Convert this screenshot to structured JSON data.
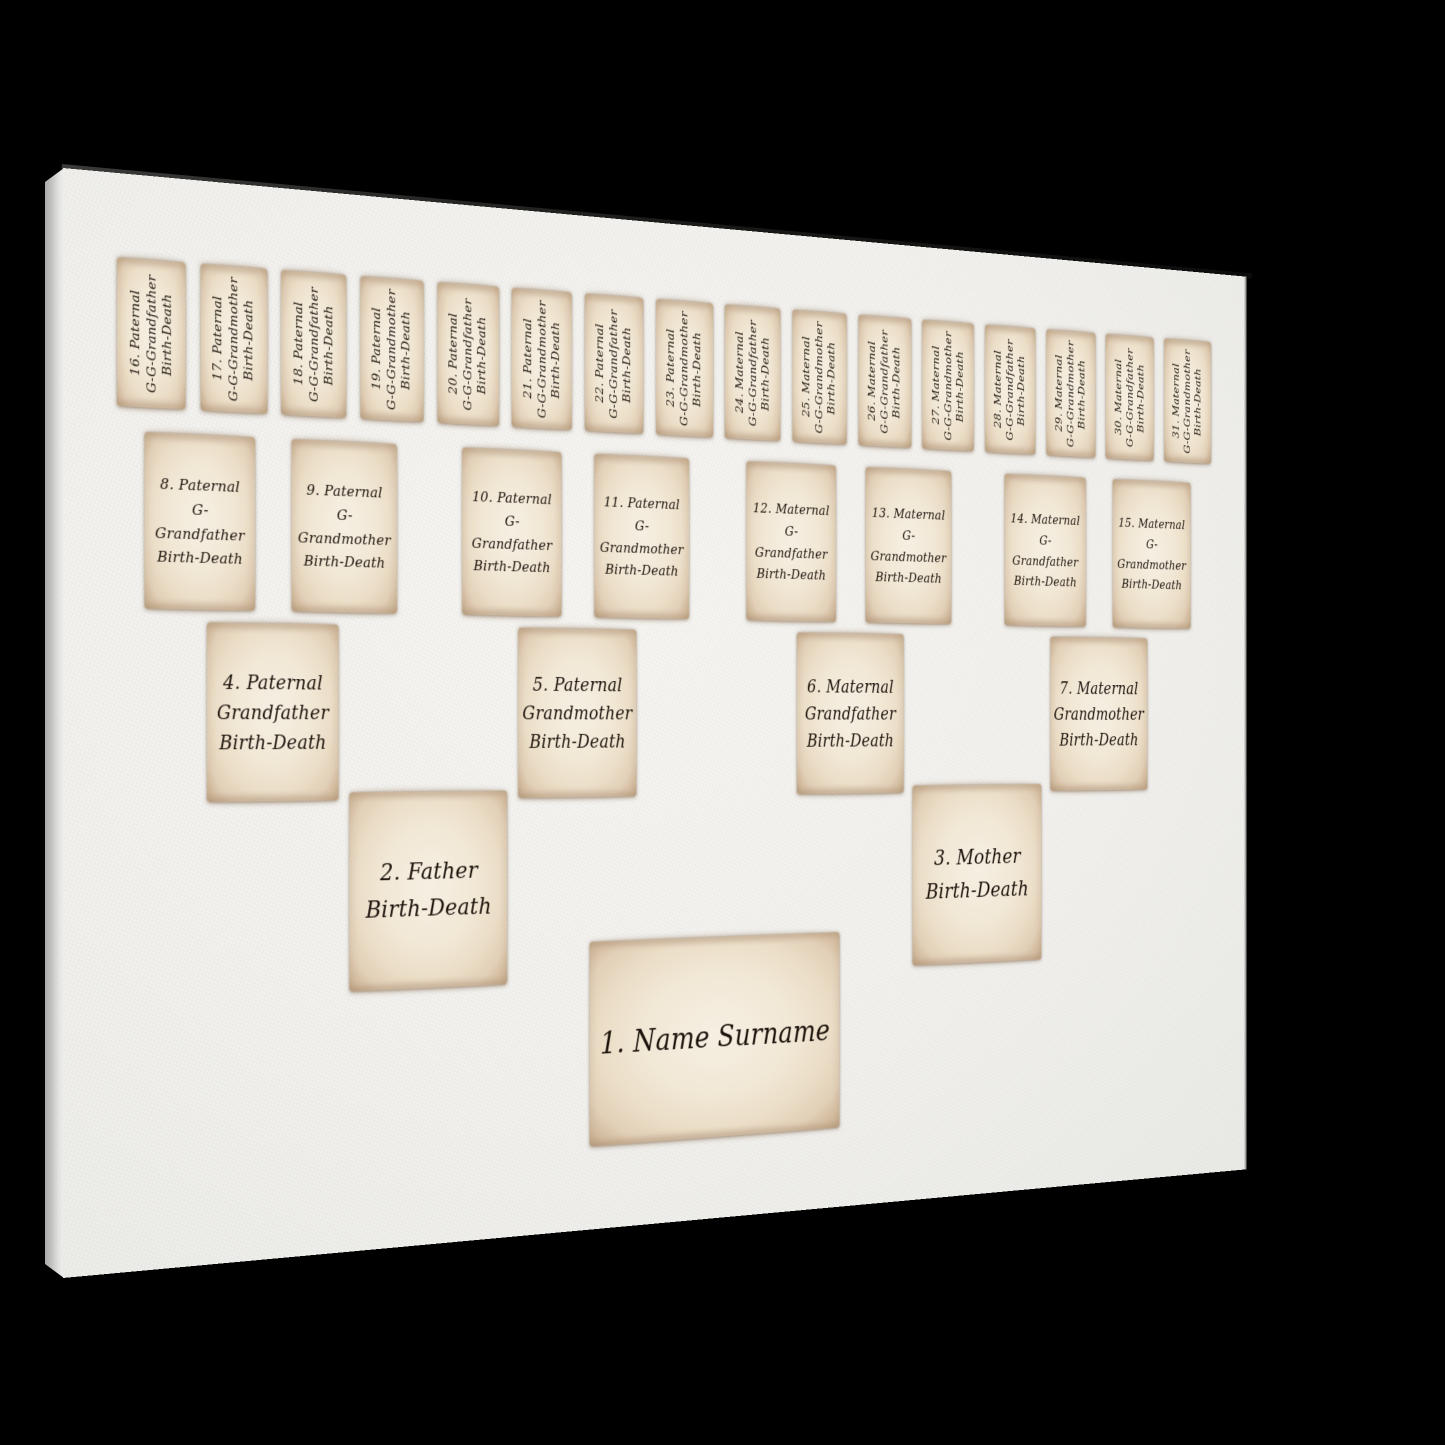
{
  "colors": {
    "background": "#000000",
    "canvas_face": "#f2f1ee",
    "canvas_edge": "#c3c3c1",
    "paper": "#f1e8d6",
    "paper_edge": "#bfa486",
    "ink": "#1c130c"
  },
  "tree": {
    "rows": [
      {
        "generation": "great-great-grandparents",
        "cards": [
          {
            "lines": [
              "16. Paternal",
              "G-G-Grandfather",
              "Birth-Death"
            ]
          },
          {
            "lines": [
              "17. Paternal",
              "G-G-Grandmother",
              "Birth-Death"
            ]
          },
          {
            "lines": [
              "18. Paternal",
              "G-G-Grandfather",
              "Birth-Death"
            ]
          },
          {
            "lines": [
              "19. Paternal",
              "G-G-Grandmother",
              "Birth-Death"
            ]
          },
          {
            "lines": [
              "20. Paternal",
              "G-G-Grandfather",
              "Birth-Death"
            ]
          },
          {
            "lines": [
              "21. Paternal",
              "G-G-Grandmother",
              "Birth-Death"
            ]
          },
          {
            "lines": [
              "22. Paternal",
              "G-G-Grandfather",
              "Birth-Death"
            ]
          },
          {
            "lines": [
              "23. Paternal",
              "G-G-Grandmother",
              "Birth-Death"
            ]
          },
          {
            "lines": [
              "24. Maternal",
              "G-G-Grandfather",
              "Birth-Death"
            ]
          },
          {
            "lines": [
              "25. Maternal",
              "G-G-Grandmother",
              "Birth-Death"
            ]
          },
          {
            "lines": [
              "26. Maternal",
              "G-G-Grandfather",
              "Birth-Death"
            ]
          },
          {
            "lines": [
              "27. Maternal",
              "G-G-Grandmother",
              "Birth-Death"
            ]
          },
          {
            "lines": [
              "28. Maternal",
              "G-G-Grandfather",
              "Birth-Death"
            ]
          },
          {
            "lines": [
              "29. Maternal",
              "G-G-Grandmother",
              "Birth-Death"
            ]
          },
          {
            "lines": [
              "30. Maternal",
              "G-G-Grandfather",
              "Birth-Death"
            ]
          },
          {
            "lines": [
              "31. Maternal",
              "G-G-Grandmother",
              "Birth-Death"
            ]
          }
        ]
      },
      {
        "generation": "great-grandparents",
        "cards": [
          {
            "lines": [
              "8. Paternal",
              "G-Grandfather",
              "Birth-Death"
            ]
          },
          {
            "lines": [
              "9. Paternal",
              "G-Grandmother",
              "Birth-Death"
            ]
          },
          {
            "lines": [
              "10. Paternal",
              "G-Grandfather",
              "Birth-Death"
            ]
          },
          {
            "lines": [
              "11. Paternal",
              "G-Grandmother",
              "Birth-Death"
            ]
          },
          {
            "lines": [
              "12. Maternal",
              "G-Grandfather",
              "Birth-Death"
            ]
          },
          {
            "lines": [
              "13. Maternal",
              "G-Grandmother",
              "Birth-Death"
            ]
          },
          {
            "lines": [
              "14. Maternal",
              "G-Grandfather",
              "Birth-Death"
            ]
          },
          {
            "lines": [
              "15. Maternal",
              "G-Grandmother",
              "Birth-Death"
            ]
          }
        ]
      },
      {
        "generation": "grandparents",
        "cards": [
          {
            "lines": [
              "4. Paternal",
              "Grandfather",
              "Birth-Death"
            ]
          },
          {
            "lines": [
              "5. Paternal",
              "Grandmother",
              "Birth-Death"
            ]
          },
          {
            "lines": [
              "6. Maternal",
              "Grandfather",
              "Birth-Death"
            ]
          },
          {
            "lines": [
              "7. Maternal",
              "Grandmother",
              "Birth-Death"
            ]
          }
        ]
      },
      {
        "generation": "parents",
        "cards": [
          {
            "lines": [
              "2. Father",
              "Birth-Death"
            ]
          },
          {
            "lines": [
              "3. Mother",
              "Birth-Death"
            ]
          }
        ]
      },
      {
        "generation": "self",
        "cards": [
          {
            "lines": [
              "1. Name Surname"
            ]
          }
        ]
      }
    ]
  }
}
